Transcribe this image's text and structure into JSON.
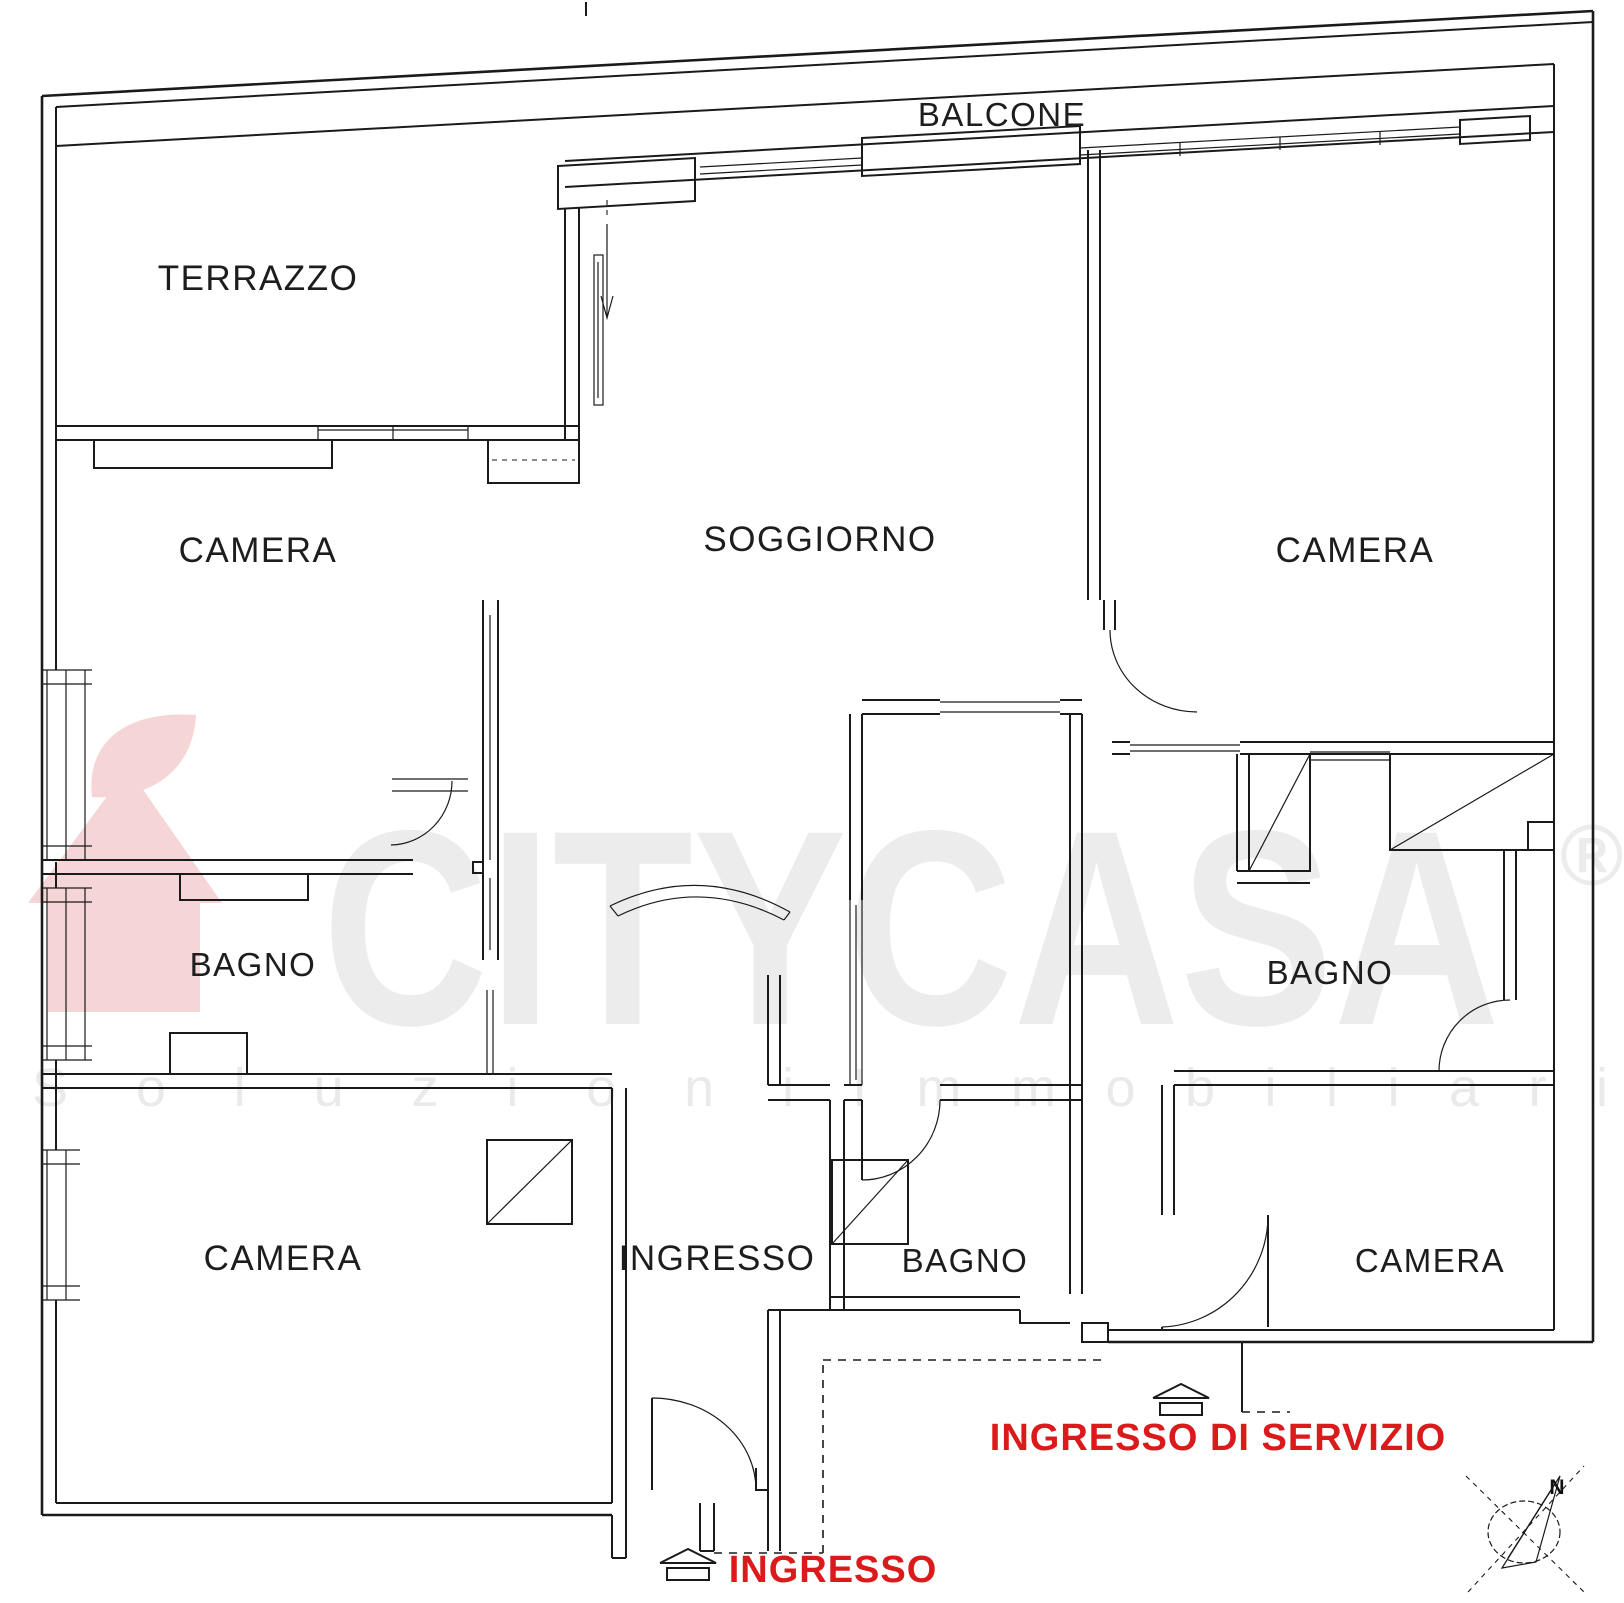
{
  "plan": {
    "rooms": [
      {
        "id": "balcone",
        "label": "BALCONE"
      },
      {
        "id": "terrazzo",
        "label": "TERRAZZO"
      },
      {
        "id": "camera-nord-ovest",
        "label": "CAMERA"
      },
      {
        "id": "soggiorno",
        "label": "SOGGIORNO"
      },
      {
        "id": "camera-nord-est",
        "label": "CAMERA"
      },
      {
        "id": "bagno-ovest",
        "label": "BAGNO"
      },
      {
        "id": "bagno-est",
        "label": "BAGNO"
      },
      {
        "id": "camera-sud-ovest",
        "label": "CAMERA"
      },
      {
        "id": "ingresso-hall",
        "label": "INGRESSO"
      },
      {
        "id": "bagno-sud",
        "label": "BAGNO"
      },
      {
        "id": "camera-sud-est",
        "label": "CAMERA"
      }
    ],
    "entrances": [
      {
        "id": "ingresso-principale",
        "label": "INGRESSO"
      },
      {
        "id": "ingresso-di-servizio",
        "label": "INGRESSO DI SERVIZIO"
      }
    ],
    "compass": {
      "north_label": "N"
    }
  },
  "watermark": {
    "brand": "CITYCASA",
    "registered": "®",
    "tagline_word1": "Soluzioni",
    "tagline_word2": "Immobiliari"
  },
  "colors": {
    "wall": "#1a1a1a",
    "room_label": "#1d1d1d",
    "entrance_red": "#db1b1b",
    "watermark_gray": "#ececec",
    "tagline_gray": "#eaeaea",
    "logo_pink": "#f5d5d5"
  }
}
